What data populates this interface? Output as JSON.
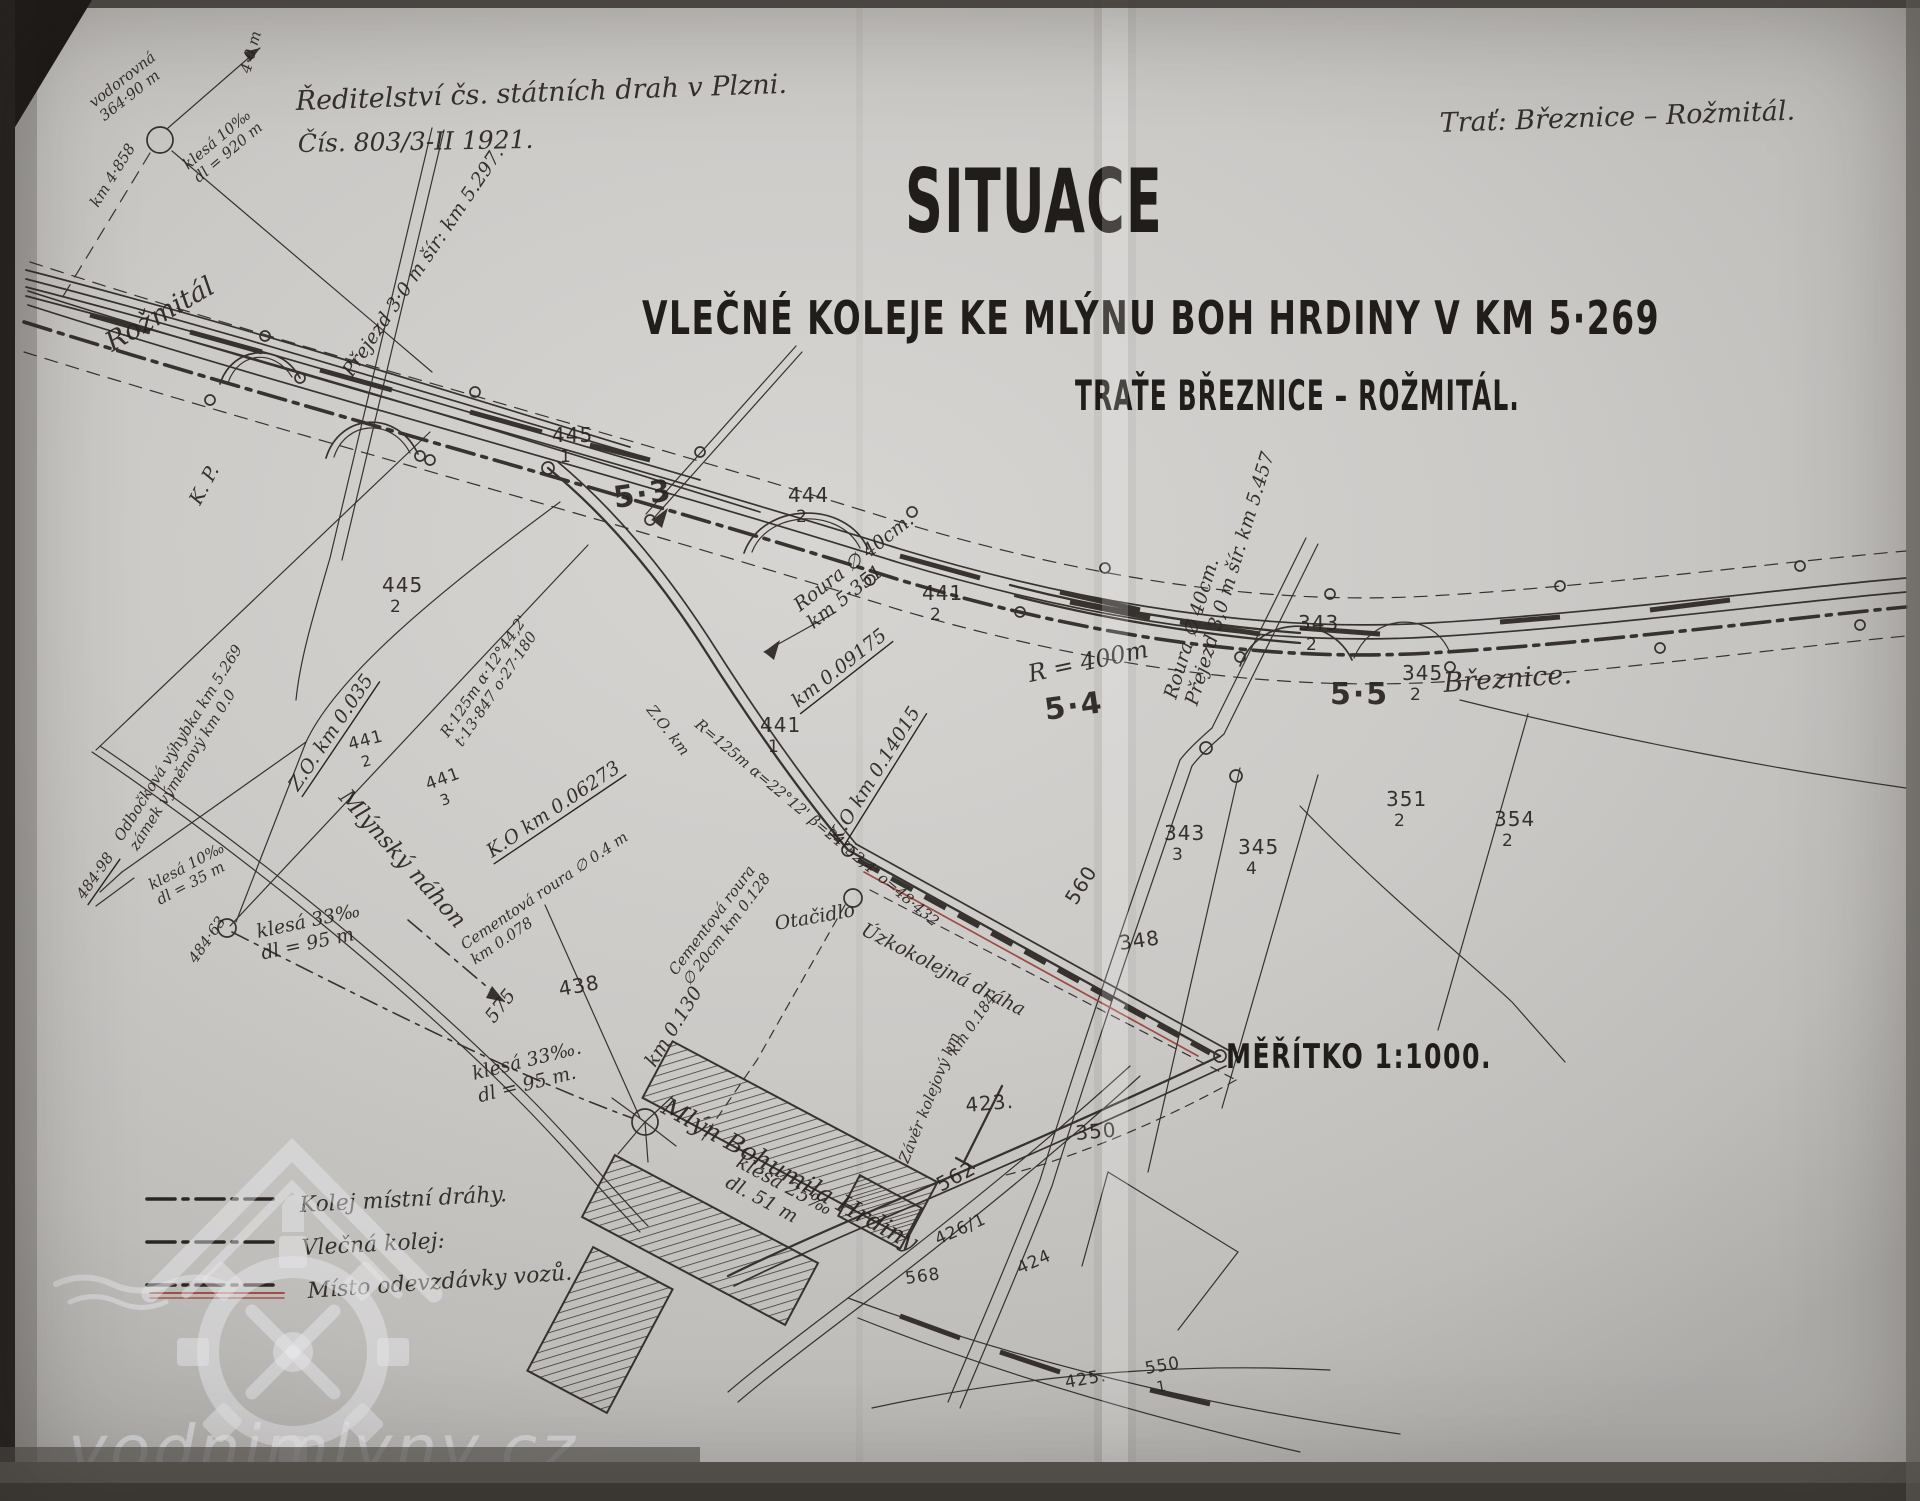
{
  "header": {
    "issuer_line1": "Ředitelství čs. státních drah v Plzni.",
    "issuer_line2": "Čís. 803/3-II 1921.",
    "route": "Trať: Březnice – Rožmitál."
  },
  "title": {
    "main": "SITUACE",
    "subtitle_line1": "VLEČNÉ KOLEJE KE MLÝNU BOH HRDINY V KM 5·269",
    "subtitle_line2": "TRAŤE BŘEZNICE – ROŽMITÁL."
  },
  "scale_label": "MĚŘÍTKO  1:1000.",
  "legend": {
    "items": [
      {
        "label": "Kolej místní dráhy.",
        "line_style": "dash-dot-black"
      },
      {
        "label": "Vlečná kolej:",
        "line_style": "dash-dot-black"
      },
      {
        "label": "Místo odevzdávky vozů.",
        "line_style": "dash-dot-black-red"
      }
    ]
  },
  "stations": {
    "left": "Rožmitál",
    "right": "Březnice."
  },
  "watermark": {
    "text": "vodnimlyny.cz"
  },
  "colors": {
    "paper": "#cccac7",
    "ink": "#2b2622",
    "red_accent": "#9a4036",
    "watermark": "#edeef1"
  },
  "map_labels": [
    {
      "t": "vodorovná",
      "t2": "364·90 m",
      "x": 94,
      "y": 108,
      "r": -38,
      "c": "cs",
      "lh": 17
    },
    {
      "t": "4·0 m",
      "x": 250,
      "y": 74,
      "r": -75,
      "c": "cs"
    },
    {
      "t": "km 4·858",
      "x": 98,
      "y": 208,
      "r": -58,
      "c": "cs"
    },
    {
      "t": "klesá 10‰",
      "t2": "dl = 920 m",
      "x": 188,
      "y": 170,
      "r": -40,
      "c": "cs",
      "lh": 17
    },
    {
      "t": "Rožmitál",
      "x": 112,
      "y": 352,
      "r": -30,
      "c": "ch"
    },
    {
      "t": "K. P.",
      "x": 200,
      "y": 506,
      "r": -62,
      "c": "c"
    },
    {
      "t": "Přejezd 3·0 m šír: km 5.297.",
      "x": 352,
      "y": 378,
      "r": -56,
      "c": "c"
    },
    {
      "t": "445",
      "sub": "1",
      "x": 552,
      "y": 442,
      "c": "p"
    },
    {
      "t": "5·3",
      "x": 615,
      "y": 508,
      "r": -8,
      "c": "pb"
    },
    {
      "t": "444",
      "sub": "2",
      "x": 788,
      "y": 502,
      "c": "p"
    },
    {
      "t": "Roura ∅ 40cm.",
      "t2": "km 5·351",
      "x": 800,
      "y": 612,
      "r": -38,
      "c": "c",
      "lh": 22
    },
    {
      "t": "km 0.09175",
      "x": 798,
      "y": 708,
      "r": -38,
      "c": "c",
      "u": 1
    },
    {
      "t": "441",
      "sub": "2",
      "x": 922,
      "y": 600,
      "c": "p"
    },
    {
      "t": "R = 400m",
      "x": 1030,
      "y": 682,
      "r": -12,
      "c": "ch",
      "s": 24
    },
    {
      "t": "5·4",
      "x": 1046,
      "y": 720,
      "r": -8,
      "c": "pb"
    },
    {
      "t": "445",
      "sub": "2",
      "x": 382,
      "y": 592,
      "c": "p"
    },
    {
      "t": "R·125m  α·12°44,2'",
      "t2": "t·13·847  o·27·180",
      "x": 448,
      "y": 738,
      "r": -56,
      "c": "cs",
      "lh": 17
    },
    {
      "t": "441",
      "sub": "3",
      "x": 428,
      "y": 790,
      "r": -20,
      "c": "p",
      "s": 17
    },
    {
      "t": "K.O  km 0.06273",
      "x": 492,
      "y": 858,
      "r": -34,
      "c": "c",
      "u": 1
    },
    {
      "t": "Cementová roura ∅ 0.4 m",
      "t2": "km 0.078",
      "x": 465,
      "y": 950,
      "r": -34,
      "c": "cs",
      "lh": 18
    },
    {
      "t": "Z.O. km 0.035",
      "x": 298,
      "y": 792,
      "r": -56,
      "c": "c",
      "u": 1
    },
    {
      "t": "441",
      "sub": "2",
      "x": 350,
      "y": 750,
      "r": -15,
      "c": "p",
      "s": 17
    },
    {
      "t": "Mlýnský náhon",
      "x": 338,
      "y": 798,
      "r": 48,
      "c": "ch",
      "s": 23
    },
    {
      "t": "Odbočková výhybka km 5.269",
      "t2": "zámek výměnový km 0.0",
      "x": 122,
      "y": 842,
      "r": -58,
      "c": "cs",
      "lh": 18
    },
    {
      "t": "484·98",
      "x": 84,
      "y": 900,
      "r": -55,
      "c": "cs",
      "u": 1
    },
    {
      "t": "484·63",
      "x": 196,
      "y": 964,
      "r": -55,
      "c": "cs"
    },
    {
      "t": "klesá 10‰",
      "t2": "dl = 35 m",
      "x": 152,
      "y": 890,
      "r": -28,
      "c": "cs",
      "lh": 17
    },
    {
      "t": "klesá 33‰",
      "t2": "dl = 95 m",
      "x": 258,
      "y": 938,
      "r": -12,
      "c": "c",
      "lh": 22
    },
    {
      "t": "Z.O. km",
      "x": 646,
      "y": 710,
      "r": 52,
      "c": "cs"
    },
    {
      "t": "R=125m  α=22°12'  β=24°52,4'  o=48·432",
      "x": 694,
      "y": 726,
      "r": 40,
      "c": "cs"
    },
    {
      "t": "441",
      "sub": "1",
      "x": 760,
      "y": 732,
      "c": "p"
    },
    {
      "t": "K.O  km 0.14015",
      "x": 838,
      "y": 844,
      "r": -58,
      "c": "c",
      "u": 1
    },
    {
      "t": "Roura ∅ 40cm.",
      "t2": "Přejezd 3,0 m šír. km 5.457",
      "x": 1176,
      "y": 700,
      "r": -73,
      "c": "c",
      "lh": 22
    },
    {
      "t": "343",
      "sub": "2",
      "x": 1298,
      "y": 630,
      "c": "p"
    },
    {
      "t": "345",
      "sub": "2",
      "x": 1402,
      "y": 680,
      "c": "p"
    },
    {
      "t": "5·5",
      "x": 1330,
      "y": 704,
      "c": "pb"
    },
    {
      "t": "Březnice.",
      "x": 1444,
      "y": 692,
      "r": -4,
      "c": "ch"
    },
    {
      "t": "351",
      "sub": "2",
      "x": 1386,
      "y": 806,
      "c": "p"
    },
    {
      "t": "354",
      "sub": "2",
      "x": 1494,
      "y": 826,
      "c": "p"
    },
    {
      "t": "343",
      "sub": "3",
      "x": 1164,
      "y": 840,
      "c": "p"
    },
    {
      "t": "345",
      "sub": "4",
      "x": 1238,
      "y": 854,
      "c": "p"
    },
    {
      "t": "348",
      "x": 1120,
      "y": 950,
      "r": -8,
      "c": "p"
    },
    {
      "t": "560",
      "x": 1076,
      "y": 906,
      "r": -58,
      "c": "p"
    },
    {
      "t": "438",
      "x": 560,
      "y": 996,
      "r": -10,
      "c": "p"
    },
    {
      "t": "575",
      "x": 494,
      "y": 1024,
      "r": -52,
      "c": "c"
    },
    {
      "t": "klesá 33‰.",
      "t2": "dl = 95 m.",
      "x": 474,
      "y": 1080,
      "r": -14,
      "c": "c",
      "lh": 23
    },
    {
      "t": "km 0.130",
      "x": 655,
      "y": 1068,
      "r": -58,
      "c": "c"
    },
    {
      "t": "Cementová roura",
      "t2": "∅ 20cm  km 0.128",
      "x": 676,
      "y": 976,
      "r": -53,
      "c": "cs",
      "lh": 17
    },
    {
      "t": "Otačidlo",
      "x": 776,
      "y": 930,
      "r": -10,
      "c": "c"
    },
    {
      "t": "Úzkokolejná dráha",
      "x": 860,
      "y": 934,
      "r": 27,
      "c": "c"
    },
    {
      "t": "km 0.184",
      "x": 956,
      "y": 1056,
      "r": -55,
      "c": "cs"
    },
    {
      "t": "Závěr kolejový km",
      "x": 908,
      "y": 1164,
      "r": -68,
      "c": "cs"
    },
    {
      "t": "Mlýn Bohumila Hrdiny",
      "x": 660,
      "y": 1112,
      "r": 29,
      "c": "ch",
      "s": 25
    },
    {
      "t": "klesá 25‰",
      "t2": "dl. 51 m",
      "x": 735,
      "y": 1166,
      "r": 28,
      "c": "c",
      "lh": 23
    },
    {
      "t": "423.",
      "x": 966,
      "y": 1112,
      "r": -5,
      "c": "p"
    },
    {
      "t": "350",
      "x": 1076,
      "y": 1140,
      "r": -5,
      "c": "p"
    },
    {
      "t": "562",
      "x": 941,
      "y": 1192,
      "r": -28,
      "c": "p"
    },
    {
      "t": "426/1",
      "x": 938,
      "y": 1245,
      "r": -24,
      "c": "p",
      "s": 17
    },
    {
      "t": "424",
      "x": 1020,
      "y": 1274,
      "r": -24,
      "c": "p",
      "s": 17
    },
    {
      "t": "568",
      "x": 906,
      "y": 1284,
      "r": -8,
      "c": "p",
      "s": 17
    },
    {
      "t": "425.",
      "x": 1066,
      "y": 1388,
      "r": -10,
      "c": "p",
      "s": 17
    },
    {
      "t": "550",
      "sub": "1",
      "x": 1146,
      "y": 1374,
      "r": -10,
      "c": "p",
      "s": 17
    }
  ]
}
